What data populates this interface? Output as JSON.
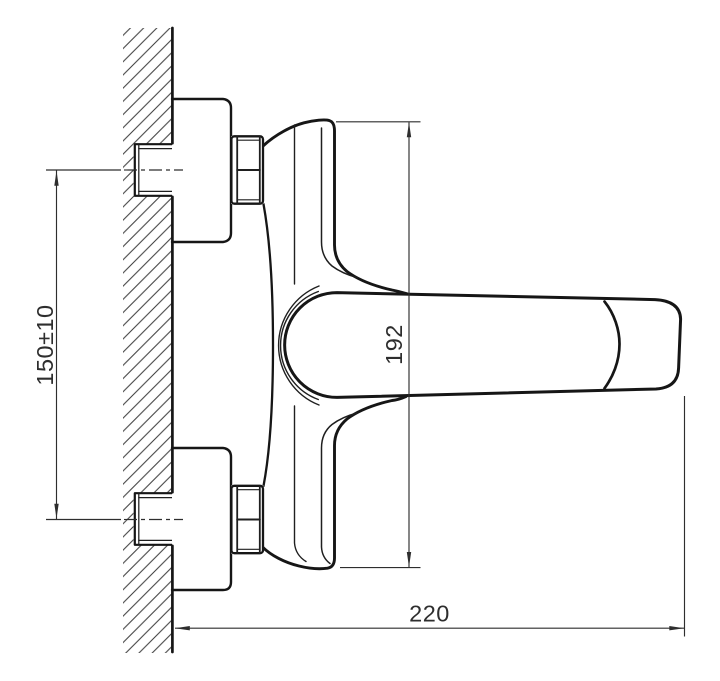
{
  "drawing": {
    "type": "technical-dimension-drawing",
    "subject": "wall-mounted single-lever mixer tap, side section view",
    "dimensions": {
      "mounting_centers_label": "150±10",
      "body_height_label": "192",
      "overall_depth_label": "220"
    },
    "colors": {
      "outline": "#161616",
      "dimension_lines": "#2e2e2e",
      "hatching": "#3f3f3f",
      "background": "#ffffff"
    }
  }
}
